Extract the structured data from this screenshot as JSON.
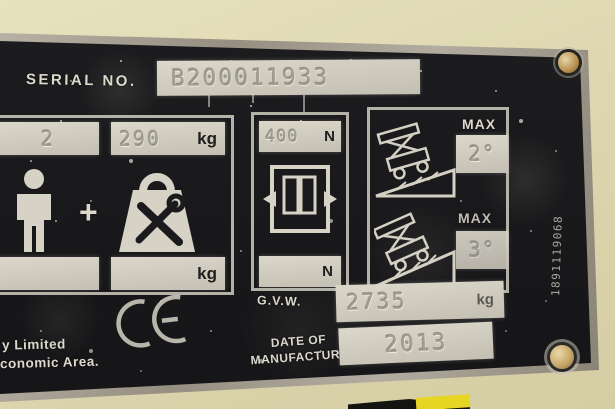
{
  "plate": {
    "serial_label": "SERIAL NO.",
    "serial_value": "B200011933",
    "occupants": "2",
    "plus_sign": "+",
    "capacity_value": "290",
    "capacity_unit": "kg",
    "capacity_bottom_unit": "kg",
    "force_value": "400",
    "force_unit": "N",
    "force_bottom_unit": "N",
    "tilt_max_label": "MAX",
    "tilt_value_1": "2°",
    "tilt_value_2": "3°",
    "ce_mark": "CE",
    "gvw_label": "G.V.W.",
    "gvw_value": "2735",
    "gvw_unit": "kg",
    "date_label_line1": "DATE OF",
    "date_label_line2": "MANUFACTURE",
    "date_value": "2013",
    "footer_line1": "y Limited",
    "footer_line2": "conomic Area.",
    "edge_stamp": "1891119068"
  },
  "icons": {
    "person": "person-icon",
    "weight_tools": "weight-with-tools-icon",
    "side_force": "side-force-arrows-icon",
    "tilt_slope_1": "machine-on-slope-icon",
    "tilt_slope_2": "machine-on-slope-icon",
    "ce": "ce-mark-icon",
    "rivet": "rivet"
  },
  "colors": {
    "background_beige": "#ded7b0",
    "plate_black": "#1b1b1d",
    "plate_border_silver": "#a8a296",
    "band_white": "#d2cec2",
    "stamp_gray": "#a19d91",
    "label_white": "#dcd8cc",
    "unit_black": "#1e1e1c",
    "rivet_brass": "#c49a5c",
    "sticker_yellow": "#e4d423"
  }
}
